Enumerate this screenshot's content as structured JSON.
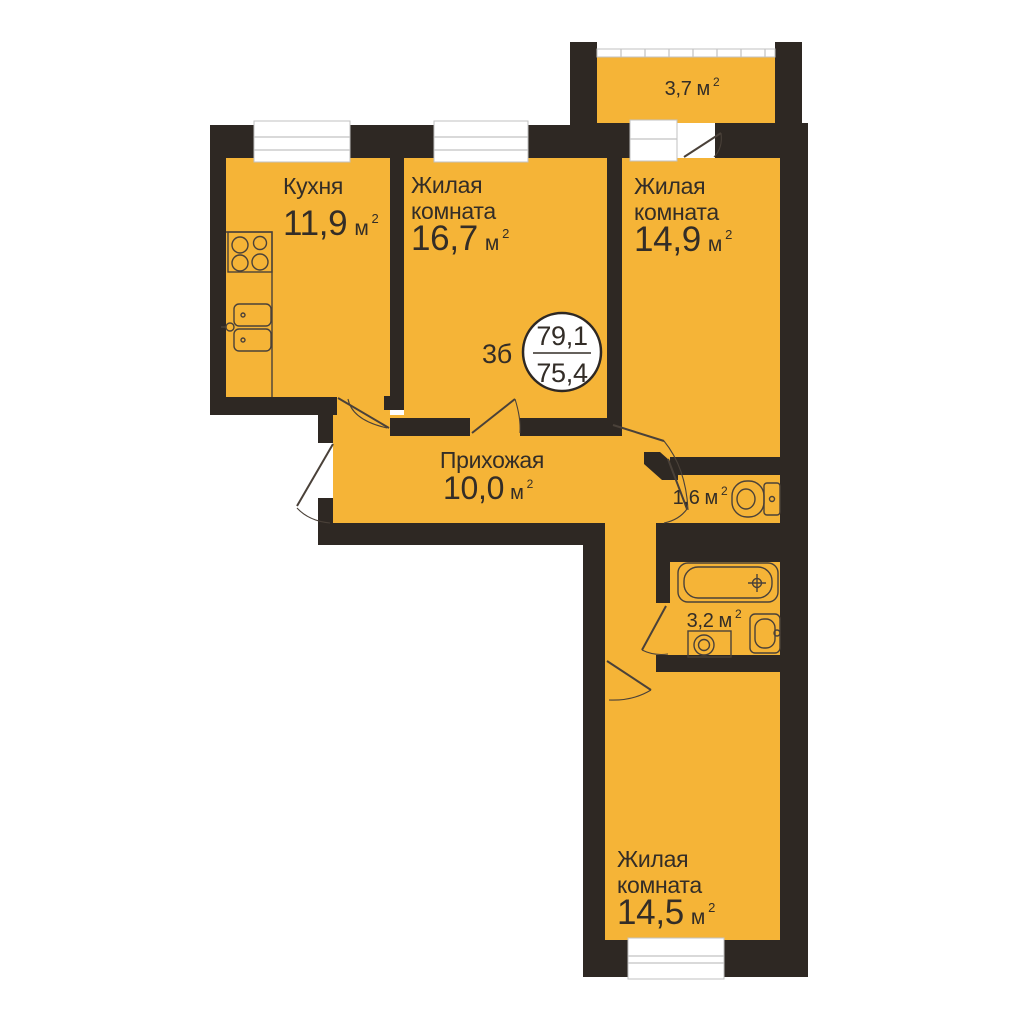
{
  "meta": {
    "plan_label": "3б",
    "total_area": "79,1",
    "living_area": "75,4"
  },
  "units": {
    "area_unit": "м",
    "sup": "2"
  },
  "rooms": {
    "kitchen": {
      "name": "Кухня",
      "area": "11,9"
    },
    "living1": {
      "name_l1": "Жилая",
      "name_l2": "комната",
      "area": "16,7"
    },
    "living2": {
      "name_l1": "Жилая",
      "name_l2": "комната",
      "area": "14,9"
    },
    "living3": {
      "name_l1": "Жилая",
      "name_l2": "комната",
      "area": "14,5"
    },
    "hallway": {
      "name": "Прихожая",
      "area": "10,0"
    },
    "wc": {
      "area": "1,6"
    },
    "bathroom": {
      "area": "3,2"
    },
    "balcony": {
      "area": "3,7"
    }
  },
  "colors": {
    "room_fill": "#F5B437",
    "wall": "#2E2823",
    "line": "#4A4139",
    "text": "#332D27",
    "window_frame": "#C2C2C2",
    "white": "#FFFFFF"
  }
}
